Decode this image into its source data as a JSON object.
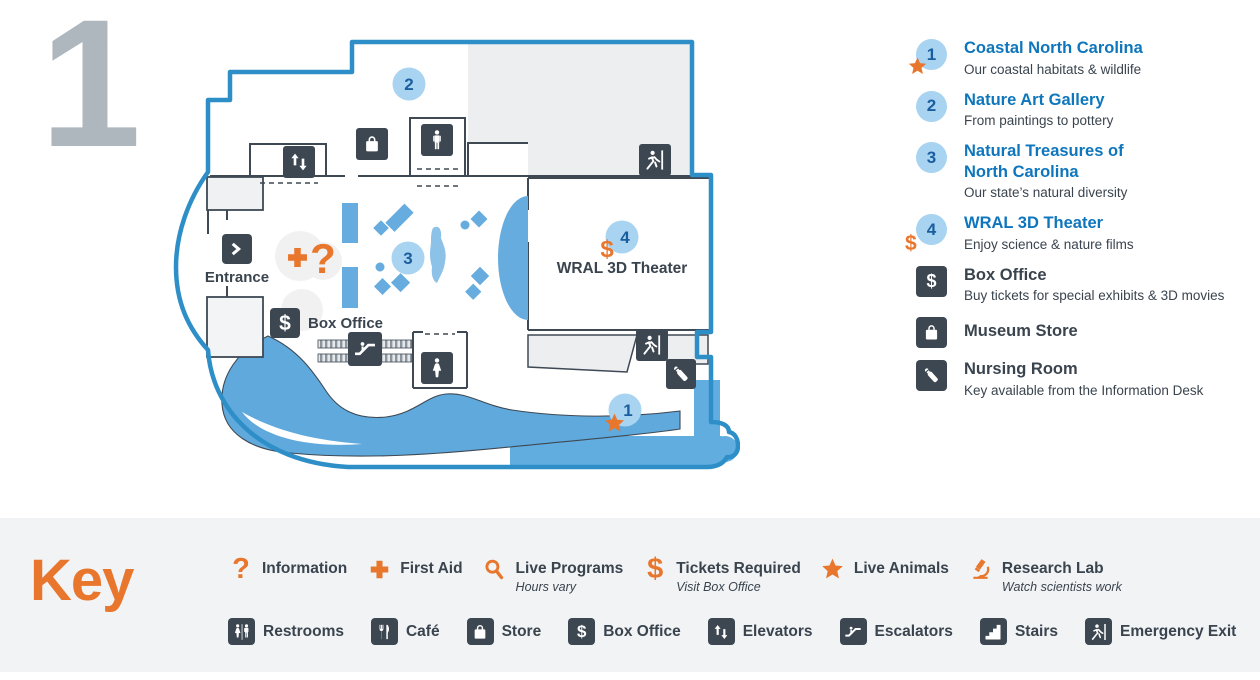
{
  "floor": {
    "number": "1"
  },
  "glyphs": {
    "question": "?",
    "dollar": "$"
  },
  "map": {
    "entrance_label": "Entrance",
    "box_office_label": "Box Office",
    "theater_label": "WRAL 3D Theater",
    "markers": [
      {
        "id": "1",
        "exhibit": "Coastal North Carolina"
      },
      {
        "id": "2",
        "exhibit": "Nature Art Gallery"
      },
      {
        "id": "3",
        "exhibit": "Natural Treasures of North Carolina"
      },
      {
        "id": "4",
        "exhibit": "WRAL 3D Theater"
      }
    ]
  },
  "legend": {
    "items": [
      {
        "badge": "1",
        "badge_type": "number-star",
        "title": "Coastal North Carolina",
        "subtitle": "Our coastal habitats & wildlife"
      },
      {
        "badge": "2",
        "badge_type": "number",
        "title": "Nature Art Gallery",
        "subtitle": "From paintings to pottery"
      },
      {
        "badge": "3",
        "badge_type": "number",
        "title": "Natural Treasures of",
        "title_line2": "North Carolina",
        "subtitle": "Our state’s natural diversity"
      },
      {
        "badge": "4",
        "badge_type": "number-dollar",
        "title": "WRAL 3D Theater",
        "subtitle": "Enjoy science & nature films"
      },
      {
        "badge_type": "icon-box-office",
        "title": "Box Office",
        "subtitle": "Buy tickets for special exhibits & 3D movies"
      },
      {
        "badge_type": "icon-store",
        "title": "Museum Store"
      },
      {
        "badge_type": "icon-nursing",
        "title": "Nursing Room",
        "subtitle": "Key available from the Information Desk"
      }
    ]
  },
  "key": {
    "title": "Key",
    "amenities": [
      {
        "label": "Information",
        "icon": "question-icon"
      },
      {
        "label": "First Aid",
        "icon": "first-aid-cross-icon"
      },
      {
        "label": "Live Programs",
        "sub": "Hours vary",
        "icon": "magnifier-icon"
      },
      {
        "label": "Tickets Required",
        "sub": "Visit Box Office",
        "icon": "dollar-icon"
      },
      {
        "label": "Live Animals",
        "icon": "star-icon"
      },
      {
        "label": "Research Lab",
        "sub": "Watch scientists work",
        "icon": "microscope-icon"
      }
    ],
    "facilities": [
      {
        "label": "Restrooms",
        "icon": "restrooms-icon"
      },
      {
        "label": "Café",
        "icon": "cafe-icon"
      },
      {
        "label": "Store",
        "icon": "store-bag-icon"
      },
      {
        "label": "Box Office",
        "icon": "box-office-dollar-icon"
      },
      {
        "label": "Elevators",
        "icon": "elevator-arrows-icon"
      },
      {
        "label": "Escalators",
        "icon": "escalator-icon"
      },
      {
        "label": "Stairs",
        "icon": "stairs-icon"
      },
      {
        "label": "Emergency Exit",
        "icon": "emergency-exit-runner-icon"
      }
    ]
  },
  "colors": {
    "accent_orange": "#E8762C",
    "brand_blue": "#0E76BC",
    "map_outline_blue": "#2E8FC8",
    "exhibit_blue": "#66ACDE",
    "water_blue": "#5FA9DC",
    "marker_circle_blue": "#A8D3F1",
    "marker_number_blue": "#1B5E9E",
    "icon_slate": "#3D4752",
    "text_dark": "#3A444E",
    "floor_number_gray": "#AFB7BE"
  }
}
